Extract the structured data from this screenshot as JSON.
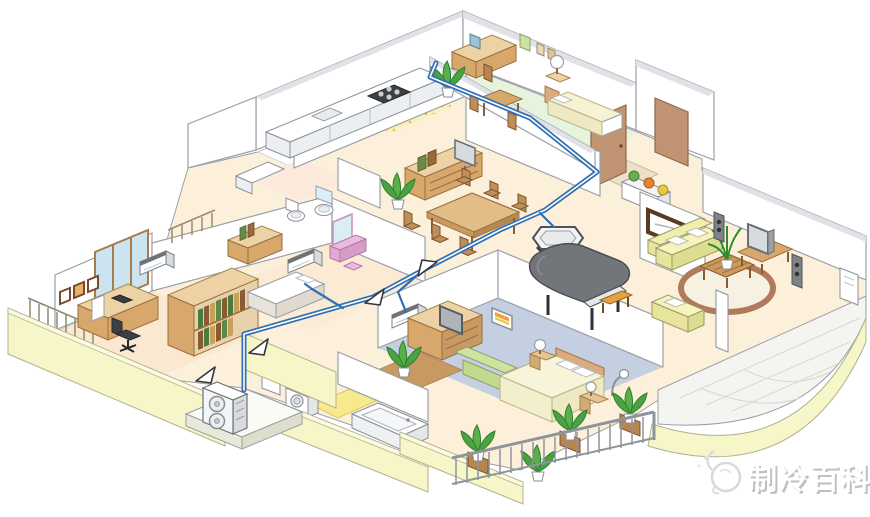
{
  "watermark": {
    "text": "制冷百科",
    "logo": "penguin-snowflake-icon"
  },
  "scene": {
    "description": "Isometric cutaway illustration of an apartment showing a multi-split air-conditioning system",
    "outdoor_unit": {
      "label": "outdoor unit",
      "fans": 2,
      "location": "outside lower-left wall on concrete base"
    },
    "indoor_units": [
      {
        "label": "wall-mounted indoor unit",
        "room": "study"
      },
      {
        "label": "wall-mounted indoor unit",
        "room": "small bedroom"
      },
      {
        "label": "wall-mounted indoor unit",
        "room": "master bedroom"
      },
      {
        "label": "ceiling cassette indoor unit",
        "room": "living room"
      }
    ],
    "piping": {
      "label": "refrigerant piping",
      "flow_arrows": 4
    },
    "rooms": [
      "kitchen",
      "dining room",
      "study",
      "small bedroom",
      "guest bedroom",
      "toilet",
      "bathroom",
      "laundry",
      "entrance hall",
      "living room",
      "master bedroom",
      "balcony"
    ]
  },
  "colors": {
    "pipe": "#2f6fb2",
    "wallEdge": "#9aa0a6",
    "exterior": "#f6f6c9",
    "floorCream": "#fdf0da",
    "floorPeach": "#fbe8d0",
    "floorGreen": "#e7f4dd",
    "carpet": "#c5cfe2",
    "tileYellow": "#f8e98e",
    "wood": "#d8a76c",
    "woodLight": "#ecd2a4",
    "sofaCream": "#f2efad",
    "sofaGreen": "#cfe3a0",
    "piano": "#72767a",
    "plant": "#2e7d32",
    "rug": "#b07a5c",
    "pinkVanity": "#ecb9e0"
  }
}
